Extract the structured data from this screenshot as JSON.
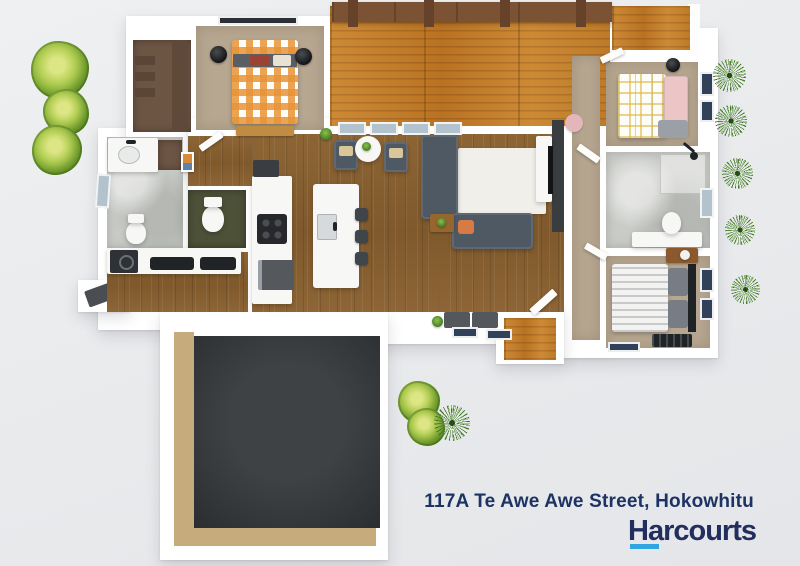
{
  "caption": {
    "address": "117A Te Awe Awe Street, Hokowhitu",
    "brand": "Harcourts"
  },
  "branding": {
    "navy": "#212e5e",
    "cyan": "#2fa6e2",
    "background": "#e9ebed"
  },
  "floor_plan": {
    "type": "3d-top-down-render",
    "rooms": [
      "deck-pergola",
      "master-bedroom",
      "walk-in-wardrobe",
      "ensuite",
      "toilet",
      "laundry",
      "kitchen",
      "living-dining",
      "hallway",
      "bedroom-2",
      "bathroom",
      "bedroom-3",
      "garage",
      "entry-porch"
    ],
    "furniture": [
      "orange-gingham-bed",
      "plaid-bed",
      "striped-bed",
      "sectional-sofa",
      "sofa",
      "rug",
      "tv-wall",
      "kitchen-island",
      "bar-stools",
      "patio-chairs",
      "round-table",
      "vanity",
      "toilets",
      "shower",
      "washing-machine"
    ],
    "landscaping": [
      "bush-row-left",
      "flax-row-right",
      "bush-group-bottom"
    ],
    "palette": {
      "wood_floor": "#875f31",
      "deck": "#c07a28",
      "carpet": "#b7a791",
      "bath_floor": "#c9cbc7",
      "garage_floor": "#34383b",
      "garage_wall": "#c6ac7c",
      "sofa": "#4e5964",
      "bed_accent_orange": "#e89437"
    }
  }
}
